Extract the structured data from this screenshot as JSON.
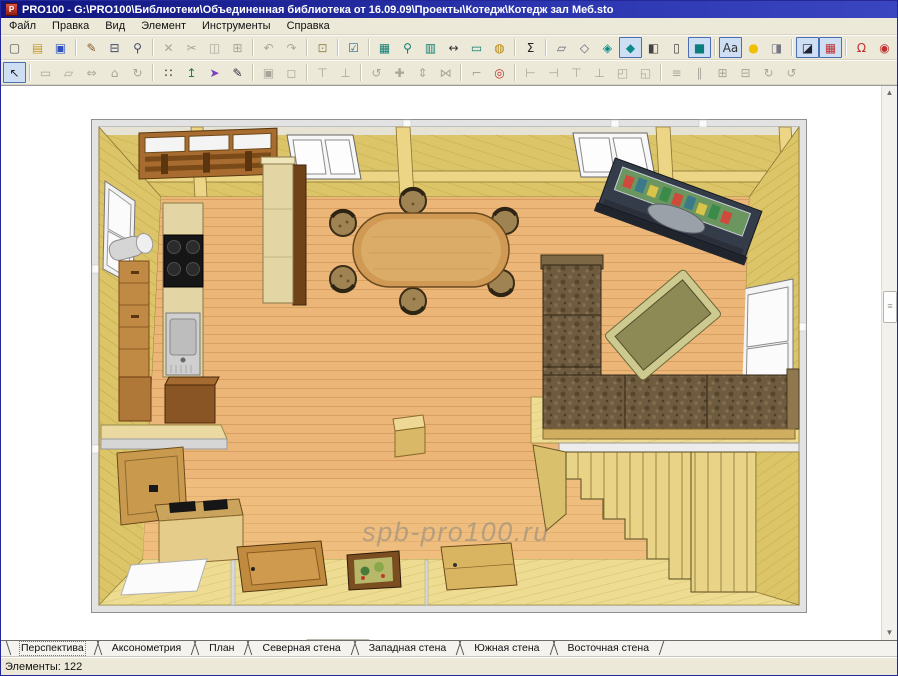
{
  "window": {
    "title": "PRO100 - G:\\PRO100\\Библиотеки\\Объединенная библиотека от 16.09.09\\Проекты\\Котедж\\Котедж зал Меб.sto"
  },
  "menu": {
    "items": [
      "Файл",
      "Правка",
      "Вид",
      "Элемент",
      "Инструменты",
      "Справка"
    ]
  },
  "toolbars": [
    [
      [
        {
          "n": "new-file",
          "g": "▢",
          "c": "#555"
        },
        {
          "n": "open-file",
          "g": "▤",
          "c": "#c89a2d"
        },
        {
          "n": "save-file",
          "g": "▣",
          "c": "#2d4fc0"
        }
      ],
      [
        {
          "n": "export-report",
          "g": "✎",
          "c": "#8a5a2a"
        },
        {
          "n": "print",
          "g": "⊟",
          "c": "#444a66"
        },
        {
          "n": "print-preview",
          "g": "⚲",
          "c": "#444a66"
        }
      ],
      [
        {
          "n": "delete",
          "g": "✕",
          "s": "d"
        },
        {
          "n": "cut",
          "g": "✂",
          "s": "d"
        },
        {
          "n": "copy",
          "g": "◫",
          "s": "d"
        },
        {
          "n": "paste",
          "g": "⊞",
          "s": "d"
        }
      ],
      [
        {
          "n": "undo",
          "g": "↶",
          "s": "d"
        },
        {
          "n": "redo",
          "g": "↷",
          "s": "d"
        }
      ],
      [
        {
          "n": "properties",
          "g": "⊡",
          "c": "#9a8a5a"
        }
      ],
      [
        {
          "n": "settings-dialog",
          "g": "☑",
          "c": "#2d6a9a"
        }
      ],
      [
        {
          "n": "price-list",
          "g": "▦",
          "c": "#0e7d72"
        },
        {
          "n": "report",
          "g": "⚲",
          "c": "#0e7d72"
        },
        {
          "n": "element-list",
          "g": "▥",
          "c": "#0e7d72"
        },
        {
          "n": "dimensions",
          "g": "↔",
          "c": "#333"
        },
        {
          "n": "notes",
          "g": "▭",
          "c": "#0e7d72"
        },
        {
          "n": "valuation",
          "g": "◍",
          "c": "#b8860b"
        }
      ],
      [
        {
          "n": "sum",
          "g": "Σ",
          "c": "#222"
        }
      ],
      [
        {
          "n": "view-wireframe",
          "g": "▱",
          "c": "#667"
        },
        {
          "n": "view-sketch",
          "g": "◇",
          "c": "#667"
        },
        {
          "n": "view-hidden-line",
          "g": "◈",
          "c": "#0e8a8a"
        },
        {
          "n": "view-solid",
          "g": "◆",
          "c": "#0e8a8a",
          "s": "p"
        },
        {
          "n": "view-box-edges",
          "g": "◧",
          "c": "#444"
        },
        {
          "n": "view-box",
          "g": "▯",
          "c": "#444"
        },
        {
          "n": "view-rendered",
          "g": "■",
          "c": "#0b7d7d",
          "s": "p"
        }
      ],
      [
        {
          "n": "show-text",
          "g": "Aa",
          "c": "#333",
          "s": "p"
        },
        {
          "n": "lighting",
          "g": "●",
          "c": "#f0c000"
        },
        {
          "n": "shading",
          "g": "◨",
          "c": "#778"
        }
      ],
      [
        {
          "n": "projection",
          "g": "◪",
          "c": "#223",
          "s": "p"
        },
        {
          "n": "show-grid",
          "g": "▦",
          "c": "#c03030",
          "s": "p"
        }
      ],
      [
        {
          "n": "snap-magnet",
          "g": "Ω",
          "c": "#c03030"
        },
        {
          "n": "snap-points",
          "g": "◉",
          "c": "#c03030"
        },
        {
          "n": "snap-center",
          "g": "◎",
          "c": "#c03030"
        }
      ],
      [
        {
          "n": "zoom-in",
          "g": "⊕",
          "s": "d"
        },
        {
          "combo": true
        },
        {
          "n": "zoom-out",
          "g": "⊖",
          "s": "d"
        }
      ]
    ],
    [
      [
        {
          "n": "select-tool",
          "g": "↖",
          "c": "#222",
          "s": "p"
        }
      ],
      [
        {
          "n": "wall-tool",
          "g": "▭",
          "s": "d"
        },
        {
          "n": "floor-tool",
          "g": "▱",
          "s": "d"
        },
        {
          "n": "resize-tool",
          "g": "⇔",
          "s": "d"
        },
        {
          "n": "room-tool",
          "g": "⌂",
          "s": "d"
        },
        {
          "n": "orbit-tool",
          "g": "↻",
          "s": "d"
        }
      ],
      [
        {
          "n": "select-region",
          "g": "∷",
          "c": "#111"
        },
        {
          "n": "move-vertical",
          "g": "↥",
          "c": "#2a7a3a"
        },
        {
          "n": "pointer-3d",
          "g": "➤",
          "c": "#7a3fbf"
        },
        {
          "n": "draw-tool",
          "g": "✎",
          "c": "#334"
        }
      ],
      [
        {
          "n": "group",
          "g": "▣",
          "s": "d"
        },
        {
          "n": "ungroup",
          "g": "◻",
          "s": "d"
        }
      ],
      [
        {
          "n": "pin-top",
          "g": "⊤",
          "s": "d"
        },
        {
          "n": "pin-bottom",
          "g": "⊥",
          "s": "d"
        }
      ],
      [
        {
          "n": "rotate",
          "g": "↺",
          "s": "d"
        },
        {
          "n": "move",
          "g": "✚",
          "s": "d"
        },
        {
          "n": "stretch",
          "g": "⇕",
          "s": "d"
        },
        {
          "n": "mirror",
          "g": "⋈",
          "s": "d"
        }
      ],
      [
        {
          "n": "corner",
          "g": "⌐",
          "s": "d"
        },
        {
          "n": "center-point",
          "g": "◎",
          "c": "#c03030"
        }
      ],
      [
        {
          "n": "align-left",
          "g": "⊢",
          "s": "d"
        },
        {
          "n": "align-right",
          "g": "⊣",
          "s": "d"
        },
        {
          "n": "align-top",
          "g": "⊤",
          "s": "d"
        },
        {
          "n": "align-bottom",
          "g": "⊥",
          "s": "d"
        },
        {
          "n": "move-front",
          "g": "◰",
          "s": "d"
        },
        {
          "n": "move-back",
          "g": "◱",
          "s": "d"
        }
      ],
      [
        {
          "n": "distribute-h",
          "g": "≡",
          "s": "d"
        },
        {
          "n": "distribute-v",
          "g": "∥",
          "s": "d"
        },
        {
          "n": "fit-width",
          "g": "⊞",
          "s": "d"
        },
        {
          "n": "fit-height",
          "g": "⊟",
          "s": "d"
        },
        {
          "n": "rotate-cw",
          "g": "↻",
          "s": "d"
        },
        {
          "n": "rotate-ccw",
          "g": "↺",
          "s": "d"
        }
      ]
    ]
  ],
  "zoom_combo": {
    "value": ""
  },
  "canvas": {
    "watermark": "spb-pro100.ru"
  },
  "tabs": {
    "items": [
      "Перспектива",
      "Аксонометрия",
      "План",
      "Северная стена",
      "Западная стена",
      "Южная стена",
      "Восточная стена"
    ],
    "active": 0
  },
  "statusbar": {
    "elements": "Элементы: 122"
  },
  "colors": {
    "floor": "#ecb679",
    "floorline": "#c98e4e",
    "wallwood": "#dcc468",
    "wallline": "#b19a33",
    "palewood": "#eddc92",
    "grayband": "#e3e3e3",
    "tablewood": "#d09a55",
    "sofa": "#6e5b40",
    "counter": "#e4d6a4",
    "cabinet": "#c08a45",
    "stairs": "#e8d387"
  }
}
